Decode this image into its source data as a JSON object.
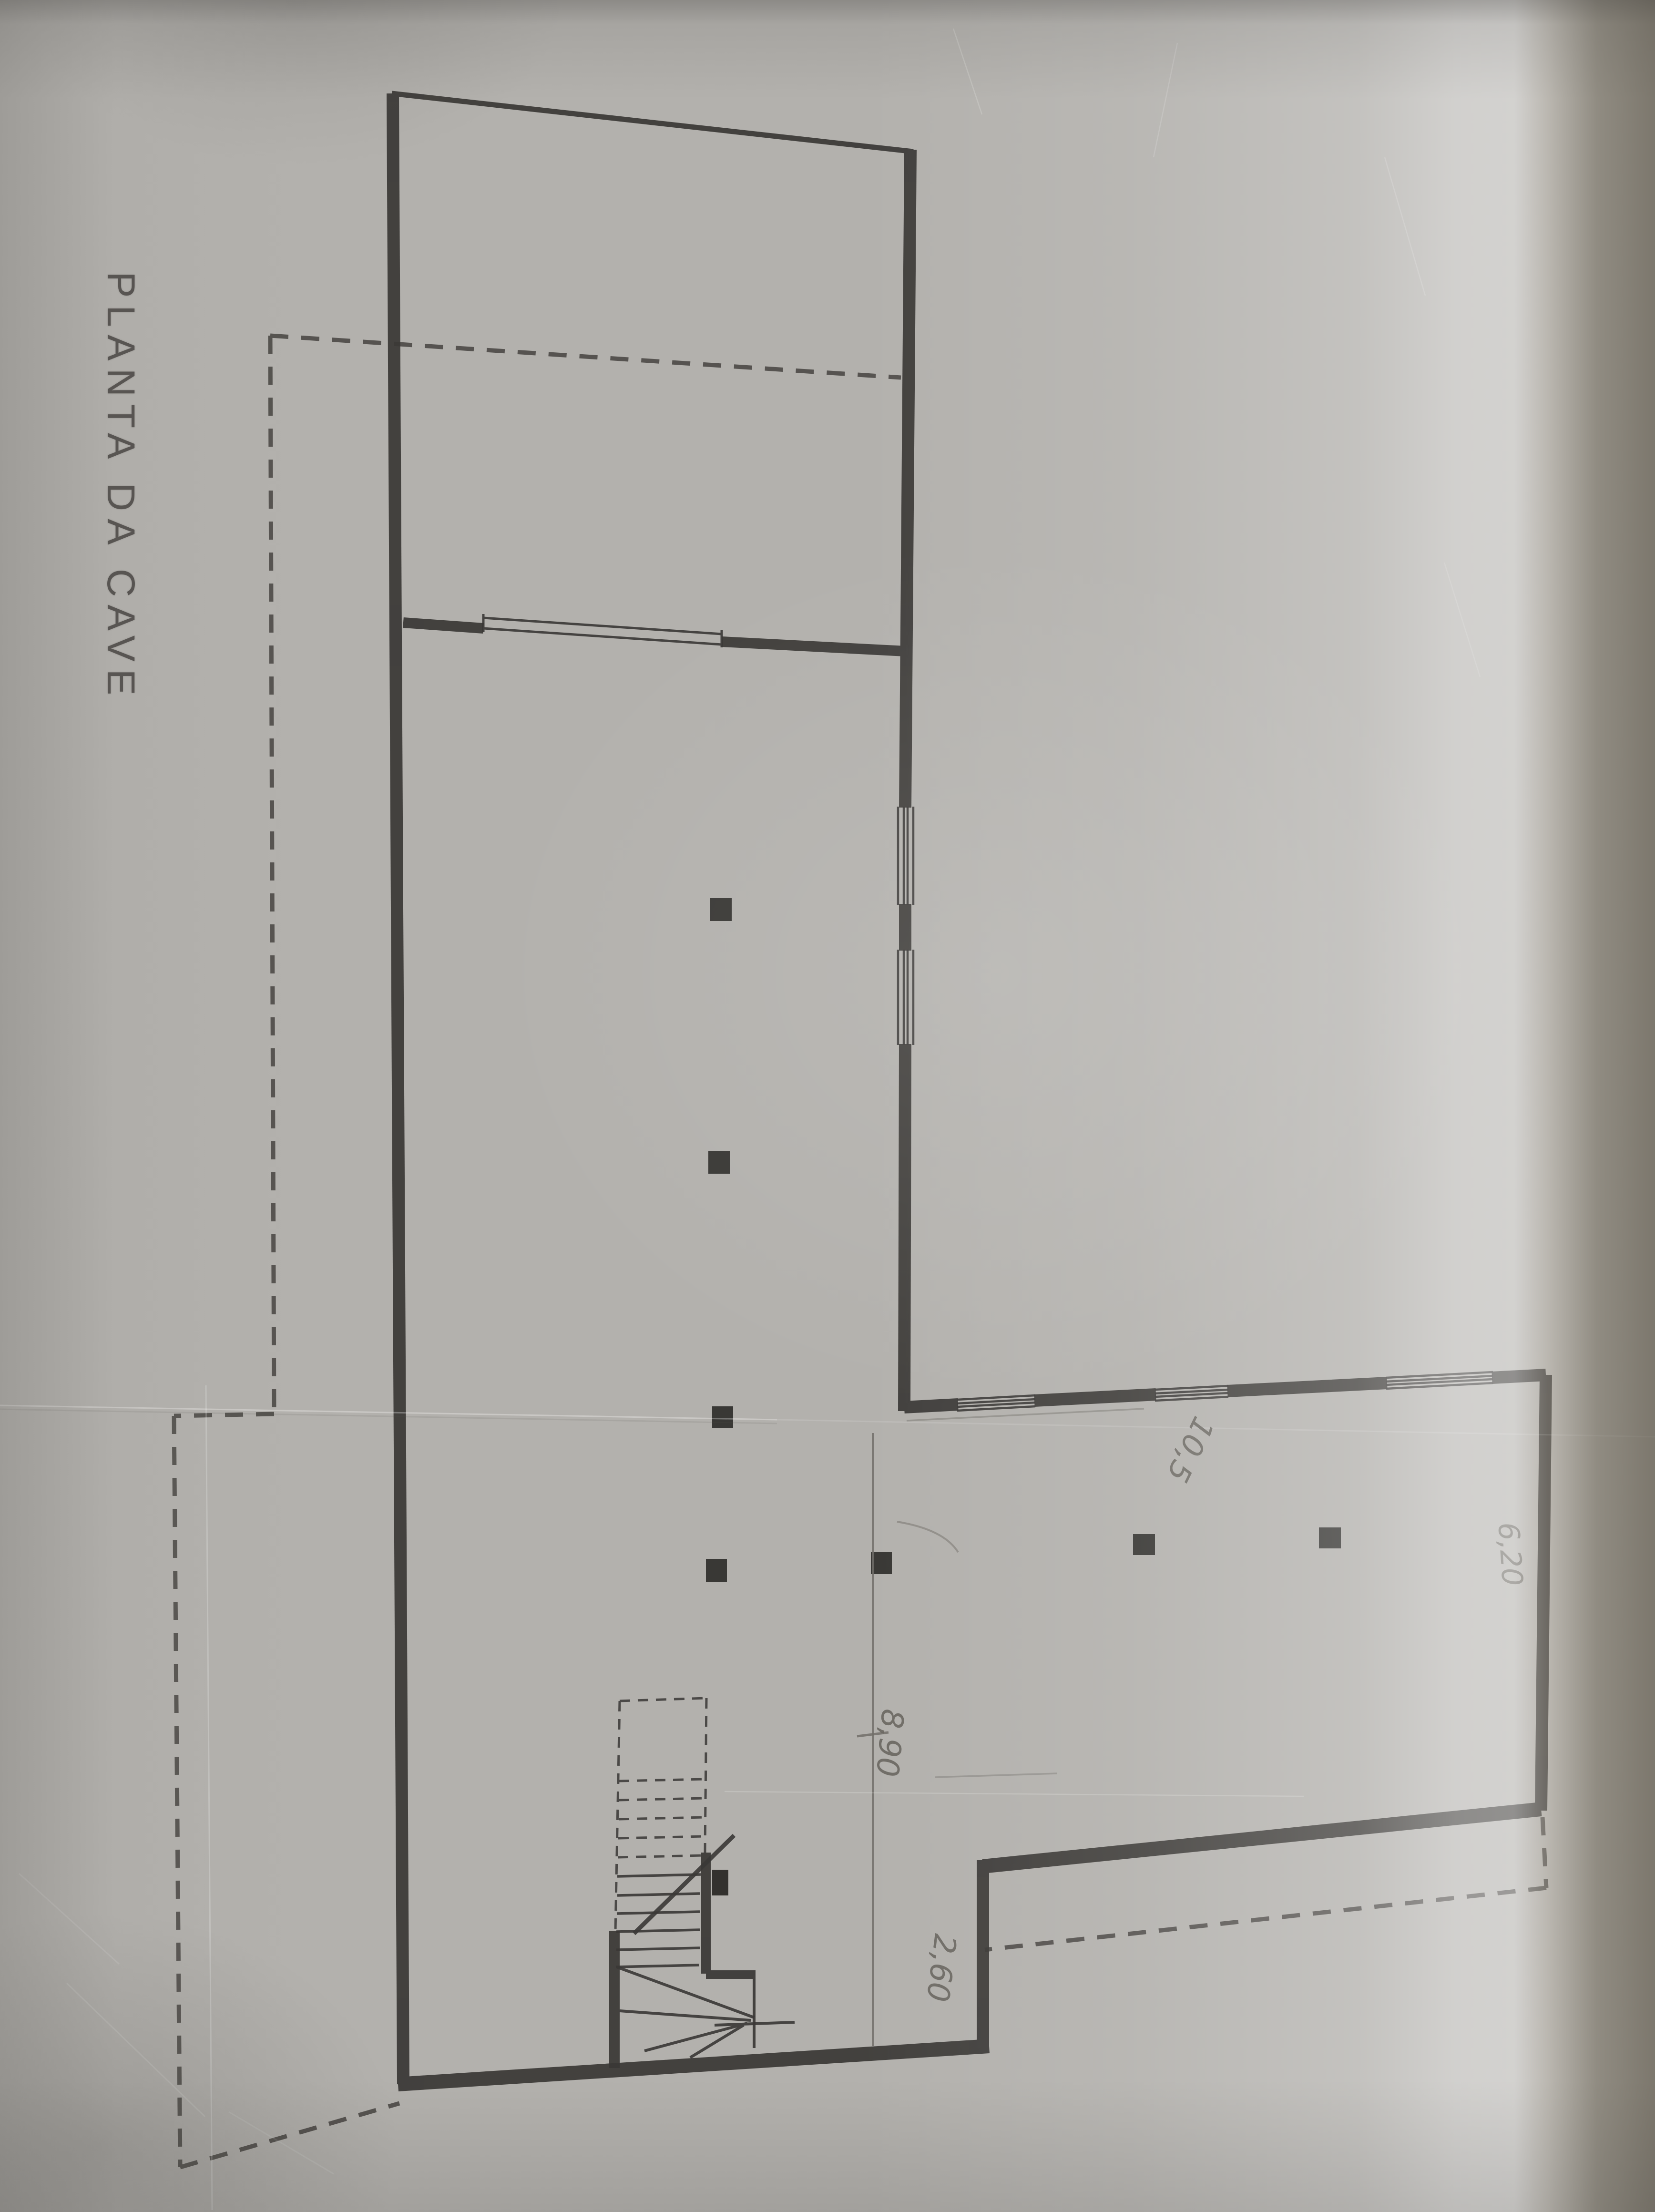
{
  "plan": {
    "title": "PLANTA DA CAVE",
    "dims": {
      "d890": "8,90",
      "d260": "2,60",
      "d105": "10,5",
      "d620": "6,20"
    }
  },
  "colors": {
    "paper": "#b3b1ad",
    "paper_bright_band": "#d2cec7",
    "paper_dark_edge": "#857d6e",
    "ink": "#3a3836",
    "pencil": "#6b6862",
    "title_ink": "#474441"
  }
}
